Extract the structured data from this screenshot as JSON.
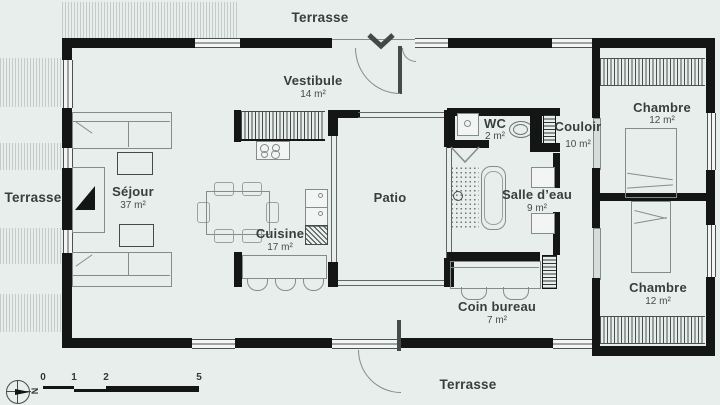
{
  "plan": {
    "terrace": {
      "top": "Terrasse",
      "left": "Terrasse",
      "bottom": "Terrasse"
    },
    "rooms": {
      "vestibule": {
        "name": "Vestibule",
        "area": "14 m²"
      },
      "sejour": {
        "name": "Séjour",
        "area": "37 m²"
      },
      "cuisine": {
        "name": "Cuisine",
        "area": "17 m²"
      },
      "patio": {
        "name": "Patio"
      },
      "wc": {
        "name": "WC",
        "area": "2 m²"
      },
      "couloir": {
        "name": "Couloir",
        "area": "10 m²"
      },
      "salle_deau": {
        "name": "Salle d’eau",
        "area": "9 m²"
      },
      "coin_bureau": {
        "name": "Coin bureau",
        "area": "7 m²"
      },
      "chambre_nord": {
        "name": "Chambre",
        "area": "12 m²"
      },
      "chambre_sud": {
        "name": "Chambre",
        "area": "12 m²"
      }
    },
    "scale_bar": {
      "ticks": [
        "0",
        "1",
        "2",
        "5"
      ]
    },
    "compass": {
      "north_letter": "N"
    },
    "colors": {
      "background": "#e8eeec",
      "wall": "#141615",
      "text": "#3a403e"
    }
  }
}
